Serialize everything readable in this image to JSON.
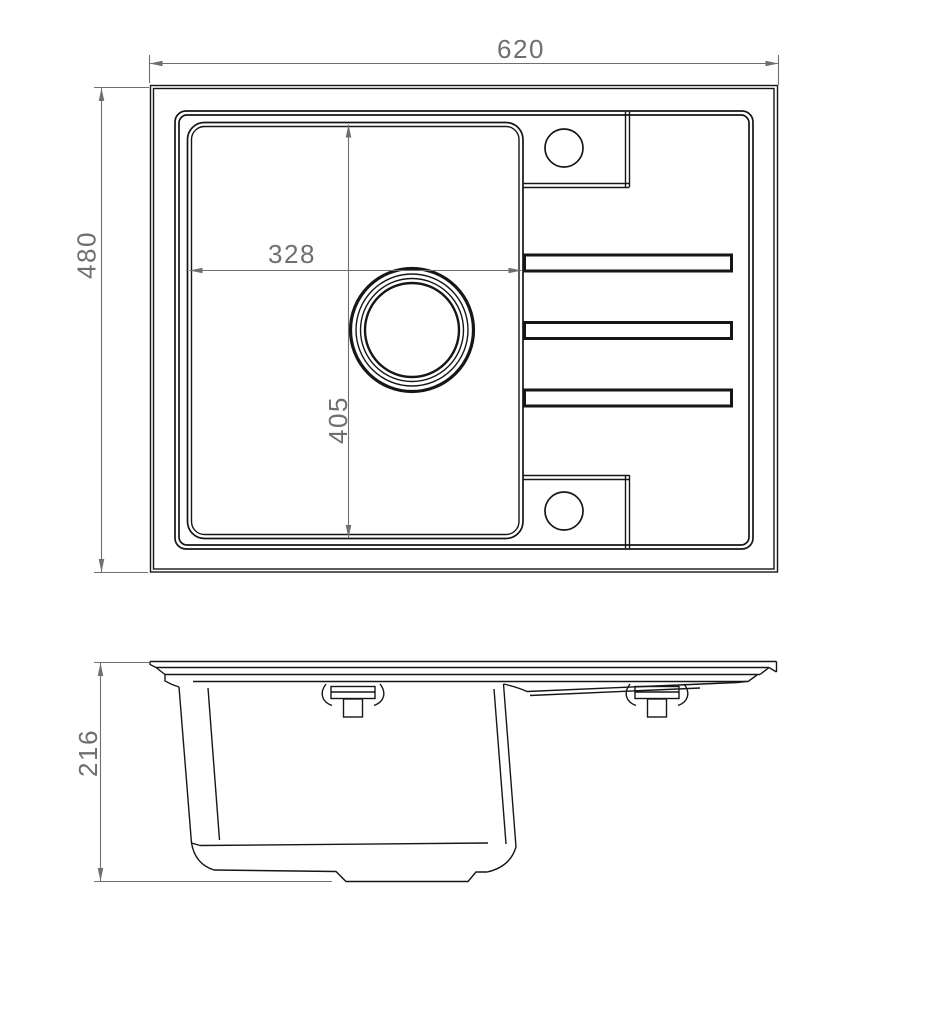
{
  "drawing": {
    "type": "technical-drawing",
    "subject": "kitchen-sink-with-drainer-dimensioned-views",
    "colors": {
      "line": "#161616",
      "dimension": "#6f6f6f",
      "background": "#ffffff"
    },
    "top_view": {
      "dimensions": {
        "overall_width": "620",
        "overall_depth": "480",
        "bowl_width": "328",
        "bowl_depth": "405"
      }
    },
    "side_view": {
      "dimensions": {
        "overall_height": "216"
      }
    }
  }
}
